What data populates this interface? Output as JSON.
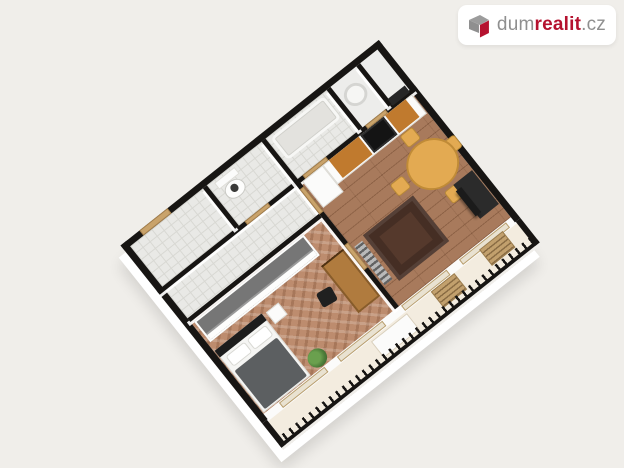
{
  "brand": {
    "prefix": "dum",
    "accent": "realit",
    "suffix": ".cz"
  },
  "colors": {
    "bg": "#f0eeea",
    "card": "#ffffff",
    "brand-gray": "#8f8f8f",
    "brand-red": "#b5122f",
    "wall": "#171513",
    "tile": "#e9e9e6",
    "tile-line": "#d8d8d3",
    "light-floor": "#ededeb",
    "wood-living": "#a87a5c",
    "wood-bed": "#bd8c6e",
    "balcony-floor": "#f3ecdf",
    "door": "#c9a36b",
    "white-wall": "#fbfbfa",
    "counter-wood": "#c07a2e",
    "appliance": "#141414",
    "table-wood": "#e3aa52",
    "rug": "#55392c",
    "duvet": "#5c5f61",
    "wardrobe": "#767676",
    "plant": "#4c7c39",
    "tv": "#1b1b1b",
    "window-glass": "#e9e2d1"
  },
  "scene": {
    "type": "3d-isometric-floorplan",
    "rooms": [
      "entry-hall",
      "wc",
      "bathroom",
      "utility-room",
      "closet",
      "hallway",
      "bedroom",
      "living-room-with-kitchen",
      "balcony"
    ],
    "furniture": [
      "toilet",
      "bathtub",
      "washing-machine",
      "fridge-cabinet",
      "kitchen-counter",
      "cooktop",
      "wall-cabinet",
      "dining-table",
      "dining-chairs",
      "tv-stand",
      "rug",
      "radiator",
      "wardrobe",
      "double-bed",
      "pillows",
      "duvet",
      "nightstand",
      "desk",
      "desk-chair",
      "plant",
      "window-wall",
      "balcony-table",
      "balcony-chairs",
      "balcony-railing"
    ]
  }
}
